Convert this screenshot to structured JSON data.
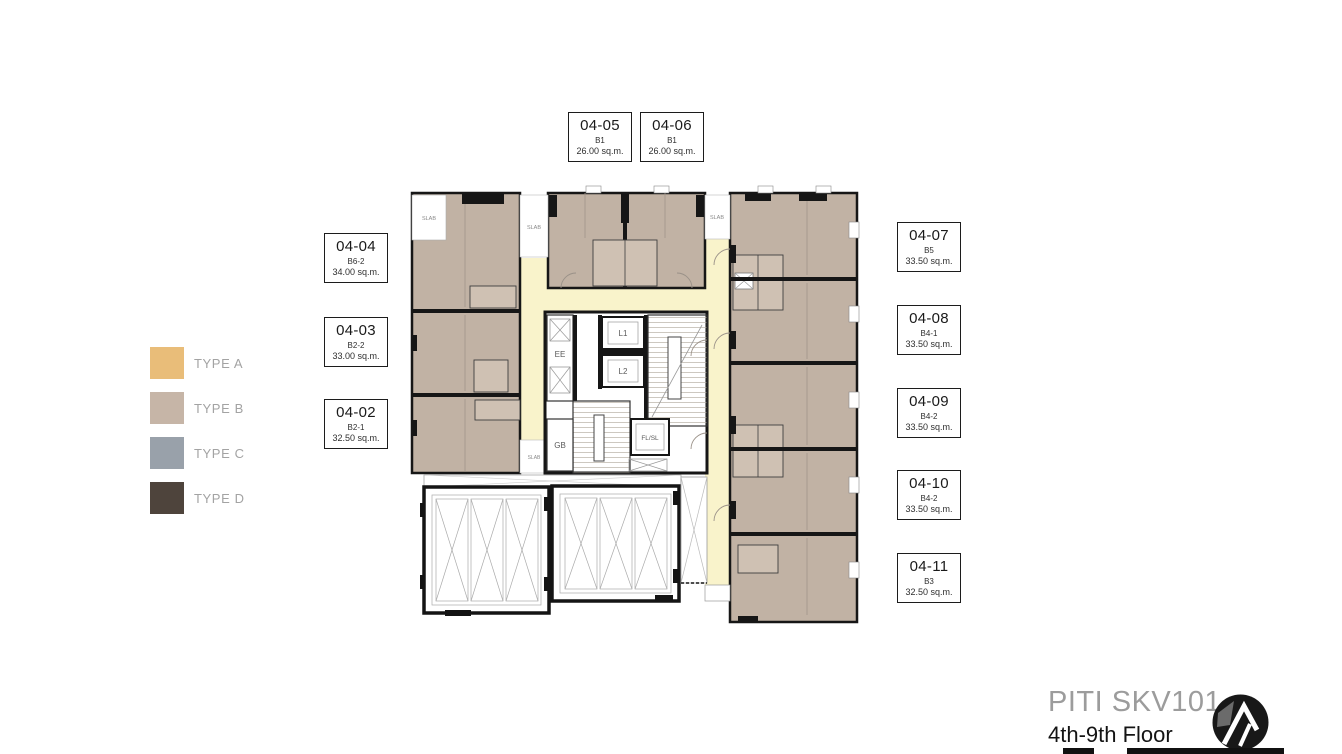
{
  "legend": {
    "items": [
      {
        "label": "TYPE A",
        "color": "#e9bd79"
      },
      {
        "label": "TYPE B",
        "color": "#c6b5a7"
      },
      {
        "label": "TYPE C",
        "color": "#99a1aa"
      },
      {
        "label": "TYPE D",
        "color": "#4e443c"
      }
    ]
  },
  "units": {
    "top": [
      {
        "id": "04-05",
        "type": "B1",
        "area": "26.00 sq.m."
      },
      {
        "id": "04-06",
        "type": "B1",
        "area": "26.00 sq.m."
      }
    ],
    "left": [
      {
        "id": "04-04",
        "type": "B6-2",
        "area": "34.00 sq.m."
      },
      {
        "id": "04-03",
        "type": "B2-2",
        "area": "33.00 sq.m."
      },
      {
        "id": "04-02",
        "type": "B2-1",
        "area": "32.50 sq.m."
      }
    ],
    "right": [
      {
        "id": "04-07",
        "type": "B5",
        "area": "33.50 sq.m."
      },
      {
        "id": "04-08",
        "type": "B4-1",
        "area": "33.50 sq.m."
      },
      {
        "id": "04-09",
        "type": "B4-2",
        "area": "33.50 sq.m."
      },
      {
        "id": "04-10",
        "type": "B4-2",
        "area": "33.50 sq.m."
      },
      {
        "id": "04-11",
        "type": "B3",
        "area": "32.50 sq.m."
      }
    ]
  },
  "plan": {
    "slab_label": "SLAB",
    "core": {
      "ee": "EE",
      "lift1": "L1",
      "lift2": "L2",
      "gb": "GB",
      "fl_sl": "FL/SL"
    }
  },
  "footer": {
    "title": "PITI SKV101",
    "subtitle": "4th-9th Floor"
  },
  "colors": {
    "room_fill": "#c1b2a4",
    "corridor_fill": "#f9f3cb",
    "wall": "#161616",
    "type_a": "#e9bd79",
    "type_b": "#c6b5a7",
    "type_c": "#99a1aa",
    "type_d": "#4e443c"
  }
}
